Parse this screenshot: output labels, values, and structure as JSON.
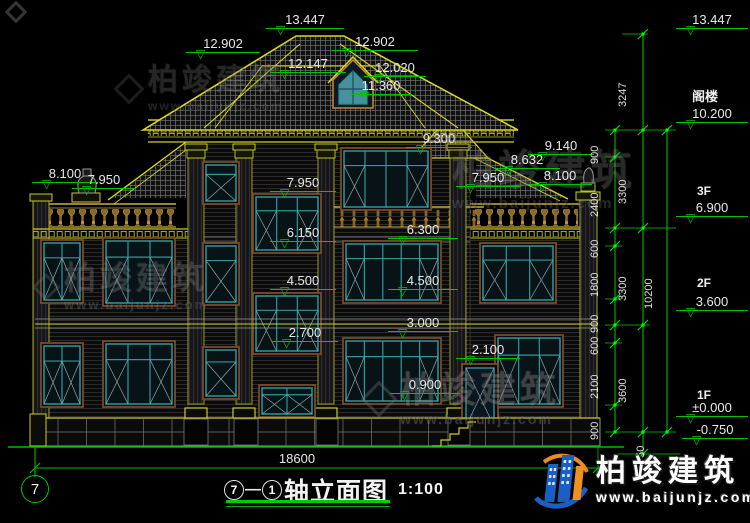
{
  "watermark": {
    "brand": "柏竣建筑",
    "url": "www.baijunjz.com"
  },
  "logo": {
    "brand": "柏竣建筑",
    "url": "www.baijunjz.com"
  },
  "title": {
    "axis_start": "7",
    "axis_end": "1",
    "dash": "—",
    "name": "轴立面图",
    "scale": "1:100"
  },
  "axis_bubble": "7",
  "plan_width": "18600",
  "marks": [
    {
      "v": "13.447"
    },
    {
      "v": "12.902"
    },
    {
      "v": "12.902"
    },
    {
      "v": "12.147"
    },
    {
      "v": "12.020"
    },
    {
      "v": "11.360"
    },
    {
      "v": "9.300"
    },
    {
      "v": "9.140"
    },
    {
      "v": "8.632"
    },
    {
      "v": "7.950"
    },
    {
      "v": "8.100"
    },
    {
      "v": "8.100"
    },
    {
      "v": "7.950"
    },
    {
      "v": "7.950"
    },
    {
      "v": "6.150"
    },
    {
      "v": "4.500"
    },
    {
      "v": "2.700"
    },
    {
      "v": "6.300"
    },
    {
      "v": "4.500"
    },
    {
      "v": "3.000"
    },
    {
      "v": "0.900"
    },
    {
      "v": "2.100"
    }
  ],
  "levels": {
    "top": "13.447",
    "attic_label": "阁楼",
    "attic": "10.200",
    "f3_label": "3F",
    "f3": "6.900",
    "f2_label": "2F",
    "f2": "3.600",
    "f1_label": "1F",
    "f1": "±0.000",
    "ground": "-0.750"
  },
  "vdims": {
    "attic_height": "3247",
    "fine": [
      "900",
      "2400",
      "600",
      "1800",
      "900",
      "600",
      "2100",
      "900"
    ],
    "base": "750",
    "floors": [
      "3300",
      "3300",
      "3600"
    ],
    "total": "10200"
  }
}
